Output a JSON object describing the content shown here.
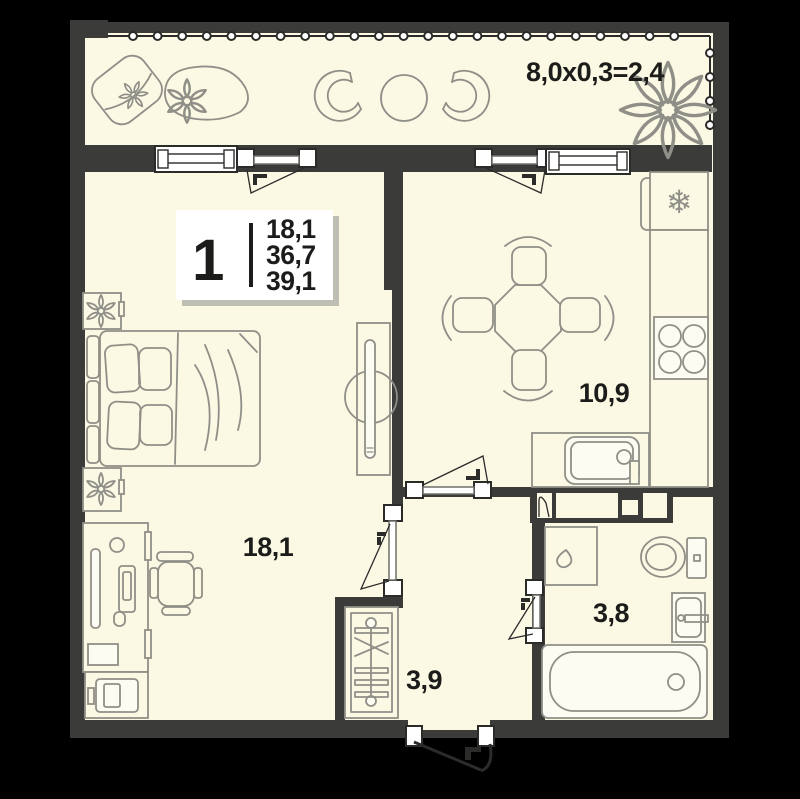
{
  "plan": {
    "type": "apartment-floor-plan",
    "legend": {
      "rooms_count": "1",
      "area_lines": [
        "18,1",
        "36,7",
        "39,1"
      ]
    },
    "labels": {
      "balcony_dimension": "8,0x0,3=2,4",
      "living_room_area": "18,1",
      "kitchen_area": "10,9",
      "hallway_area": "3,9",
      "bathroom_area": "3,8"
    },
    "icons": {
      "fridge_snowflake": "❄"
    },
    "colors": {
      "background": "#000000",
      "floor": "#FBF8E4",
      "walls": "#3B3B39",
      "furniture_outline": "#8F8F87",
      "text": "#1C1C1A",
      "legend_background": "#FFFFFF"
    }
  }
}
